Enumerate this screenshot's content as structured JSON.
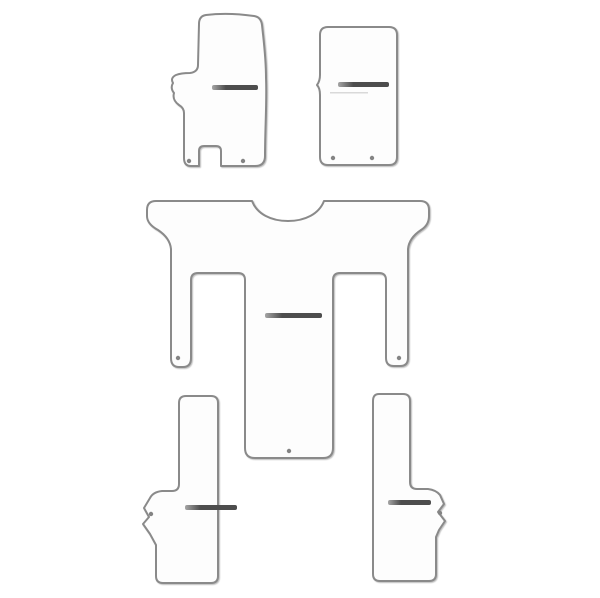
{
  "page": {
    "background": "#ffffff"
  },
  "colors": {
    "page_background": "#ffffff",
    "mat_fill": "#fdfdfd",
    "outline": "#8a8a8a",
    "logo_dark": "#4d4d4d",
    "logo_light": "#a6a6a6",
    "logo_underline": "#d9d9d9",
    "fixing_point": "#848484"
  },
  "product": {
    "pieces": 5,
    "mats": {
      "front_left": {
        "id": "front-left-mat",
        "has_logo_bar": true,
        "fixing_points": 2
      },
      "front_right": {
        "id": "front-right-mat",
        "has_logo_bar": true,
        "fixing_points": 2
      },
      "rear_one_piece": {
        "id": "rear-one-piece-mat",
        "has_logo_bar": true,
        "fixing_points": 3
      },
      "rear_left_strip": {
        "id": "rear-left-strip-mat",
        "has_logo_bar": true,
        "fixing_points": 1
      },
      "rear_right_strip": {
        "id": "rear-right-strip-mat",
        "has_logo_bar": true,
        "fixing_points": 1
      }
    }
  }
}
